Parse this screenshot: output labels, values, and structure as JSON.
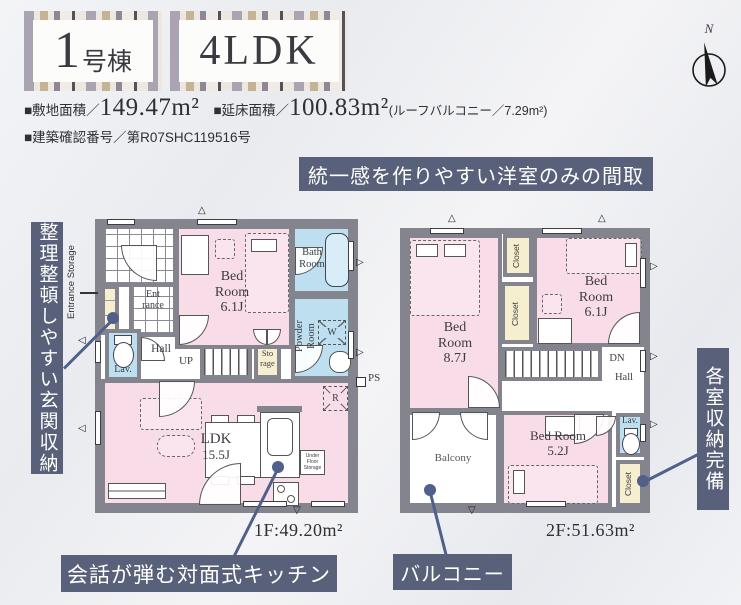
{
  "header": {
    "building_number": "1",
    "building_suffix": "号棟",
    "layout": "4LDK",
    "site_area_label": "■敷地面積／",
    "site_area_value": "149.47m²",
    "floor_area_label": "■延床面積／",
    "floor_area_value": "100.83m²",
    "roof_note": "(ルーフバルコニー／7.29m²)",
    "confirmation": "■建築確認番号／第R07SHC119516号",
    "compass_label": "N"
  },
  "banners": {
    "top": "統一感を作りやすい洋室のみの間取",
    "left": "整理整頓しやすい玄関収納",
    "right": "各室収納完備",
    "kitchen": "会話が弾む対面式キッチン",
    "balcony": "バルコニー"
  },
  "floor1": {
    "area_label": "1F:49.20m²",
    "entrance_storage": "Entrance Storage",
    "entrance_line1": "Ent",
    "entrance_line2": "rance",
    "lav": "Lav.",
    "hall": "Hall",
    "bedroom_name": "Bed Room",
    "bedroom_size": "6.1J",
    "bath_line1": "Bath",
    "bath_line2": "Room",
    "powder_line1": "Powder",
    "powder_line2": "Room",
    "up": "UP",
    "storage_line1": "Sto",
    "storage_line2": "rage",
    "ldk_name": "LDK",
    "ldk_size": "15.5J",
    "under_floor_storage": "Under Floor Storage",
    "ps": "PS",
    "fridge": "R",
    "washer": "W"
  },
  "floor2": {
    "area_label": "2F:51.63m²",
    "bedroom87_name": "Bed Room",
    "bedroom87_size": "8.7J",
    "bedroom61_name": "Bed Room",
    "bedroom61_size": "6.1J",
    "bedroom52_name": "Bed Room",
    "bedroom52_size": "5.2J",
    "closet": "Closet",
    "balcony": "Balcony",
    "dn": "DN",
    "hall": "Hall",
    "lav": "Lav."
  },
  "colors": {
    "room_pink": "#f8dde9",
    "room_blue": "#bedff0",
    "room_cream": "#f6efcf",
    "wall_gray": "#84848e",
    "banner_slate": "#59617a",
    "connector": "#51608a"
  }
}
